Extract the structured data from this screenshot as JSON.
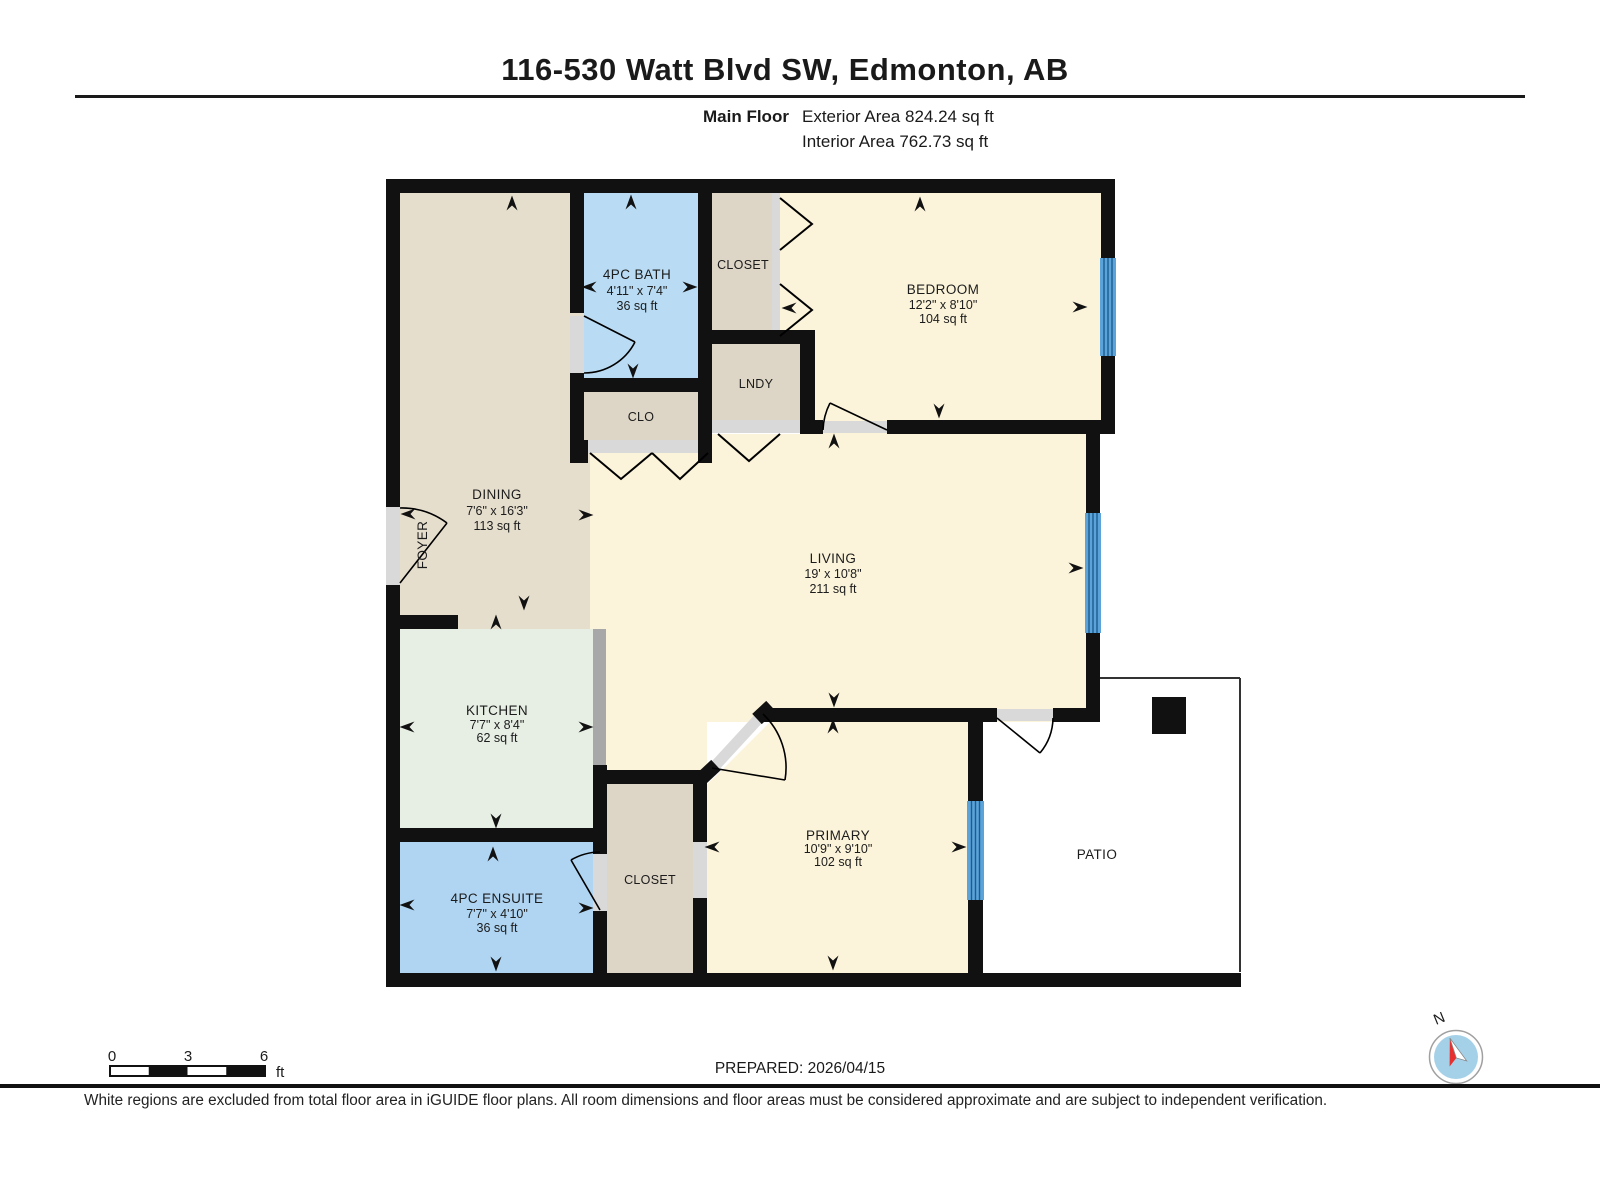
{
  "header": {
    "title": "116-530 Watt Blvd SW, Edmonton, AB",
    "floor_label": "Main Floor",
    "exterior_area": "Exterior Area 824.24 sq ft",
    "interior_area": "Interior Area 762.73 sq ft"
  },
  "rooms": {
    "bath": {
      "name": "4PC BATH",
      "dims": "4'11\" x 7'4\"",
      "area": "36 sq ft"
    },
    "closet_top": {
      "name": "CLOSET"
    },
    "bedroom": {
      "name": "BEDROOM",
      "dims": "12'2\" x 8'10\"",
      "area": "104 sq ft"
    },
    "lndy": {
      "name": "LNDY"
    },
    "clo": {
      "name": "CLO"
    },
    "dining": {
      "name": "DINING",
      "dims": "7'6\" x 16'3\"",
      "area": "113 sq ft"
    },
    "foyer": {
      "name": "FOYER"
    },
    "living": {
      "name": "LIVING",
      "dims": "19' x 10'8\"",
      "area": "211 sq ft"
    },
    "kitchen": {
      "name": "KITCHEN",
      "dims": "7'7\" x 8'4\"",
      "area": "62 sq ft"
    },
    "ensuite": {
      "name": "4PC ENSUITE",
      "dims": "7'7\" x 4'10\"",
      "area": "36 sq ft"
    },
    "closet_bottom": {
      "name": "CLOSET"
    },
    "primary": {
      "name": "PRIMARY",
      "dims": "10'9\" x 9'10\"",
      "area": "102 sq ft"
    },
    "patio": {
      "name": "PATIO"
    }
  },
  "scale_bar": {
    "tick_0": "0",
    "tick_3": "3",
    "tick_6": "6",
    "unit": "ft"
  },
  "compass": {
    "north_label": "N"
  },
  "footer": {
    "prepared": "PREPARED: 2026/04/15",
    "disclaimer": "White regions are excluded from total floor area in iGUIDE floor plans. All room dimensions and floor areas must be considered approximate and are subject to independent verification."
  },
  "colors": {
    "wall": "#111111",
    "room_cream": "#fcf4da",
    "room_tan": "#e6decd",
    "room_closet_tan": "#ddd5c5",
    "room_bath_blue": "#b9dcf4",
    "room_ensuite_blue": "#b0d5f2",
    "room_kitchen_mint": "#e7efe4",
    "window_fill": "#5ba3d9",
    "window_line": "#1c5c8f",
    "door_gray": "#d9d9d9",
    "counter_gray": "#a8a8a8",
    "compass_blue": "#a5d1e8",
    "compass_red": "#e63030"
  }
}
